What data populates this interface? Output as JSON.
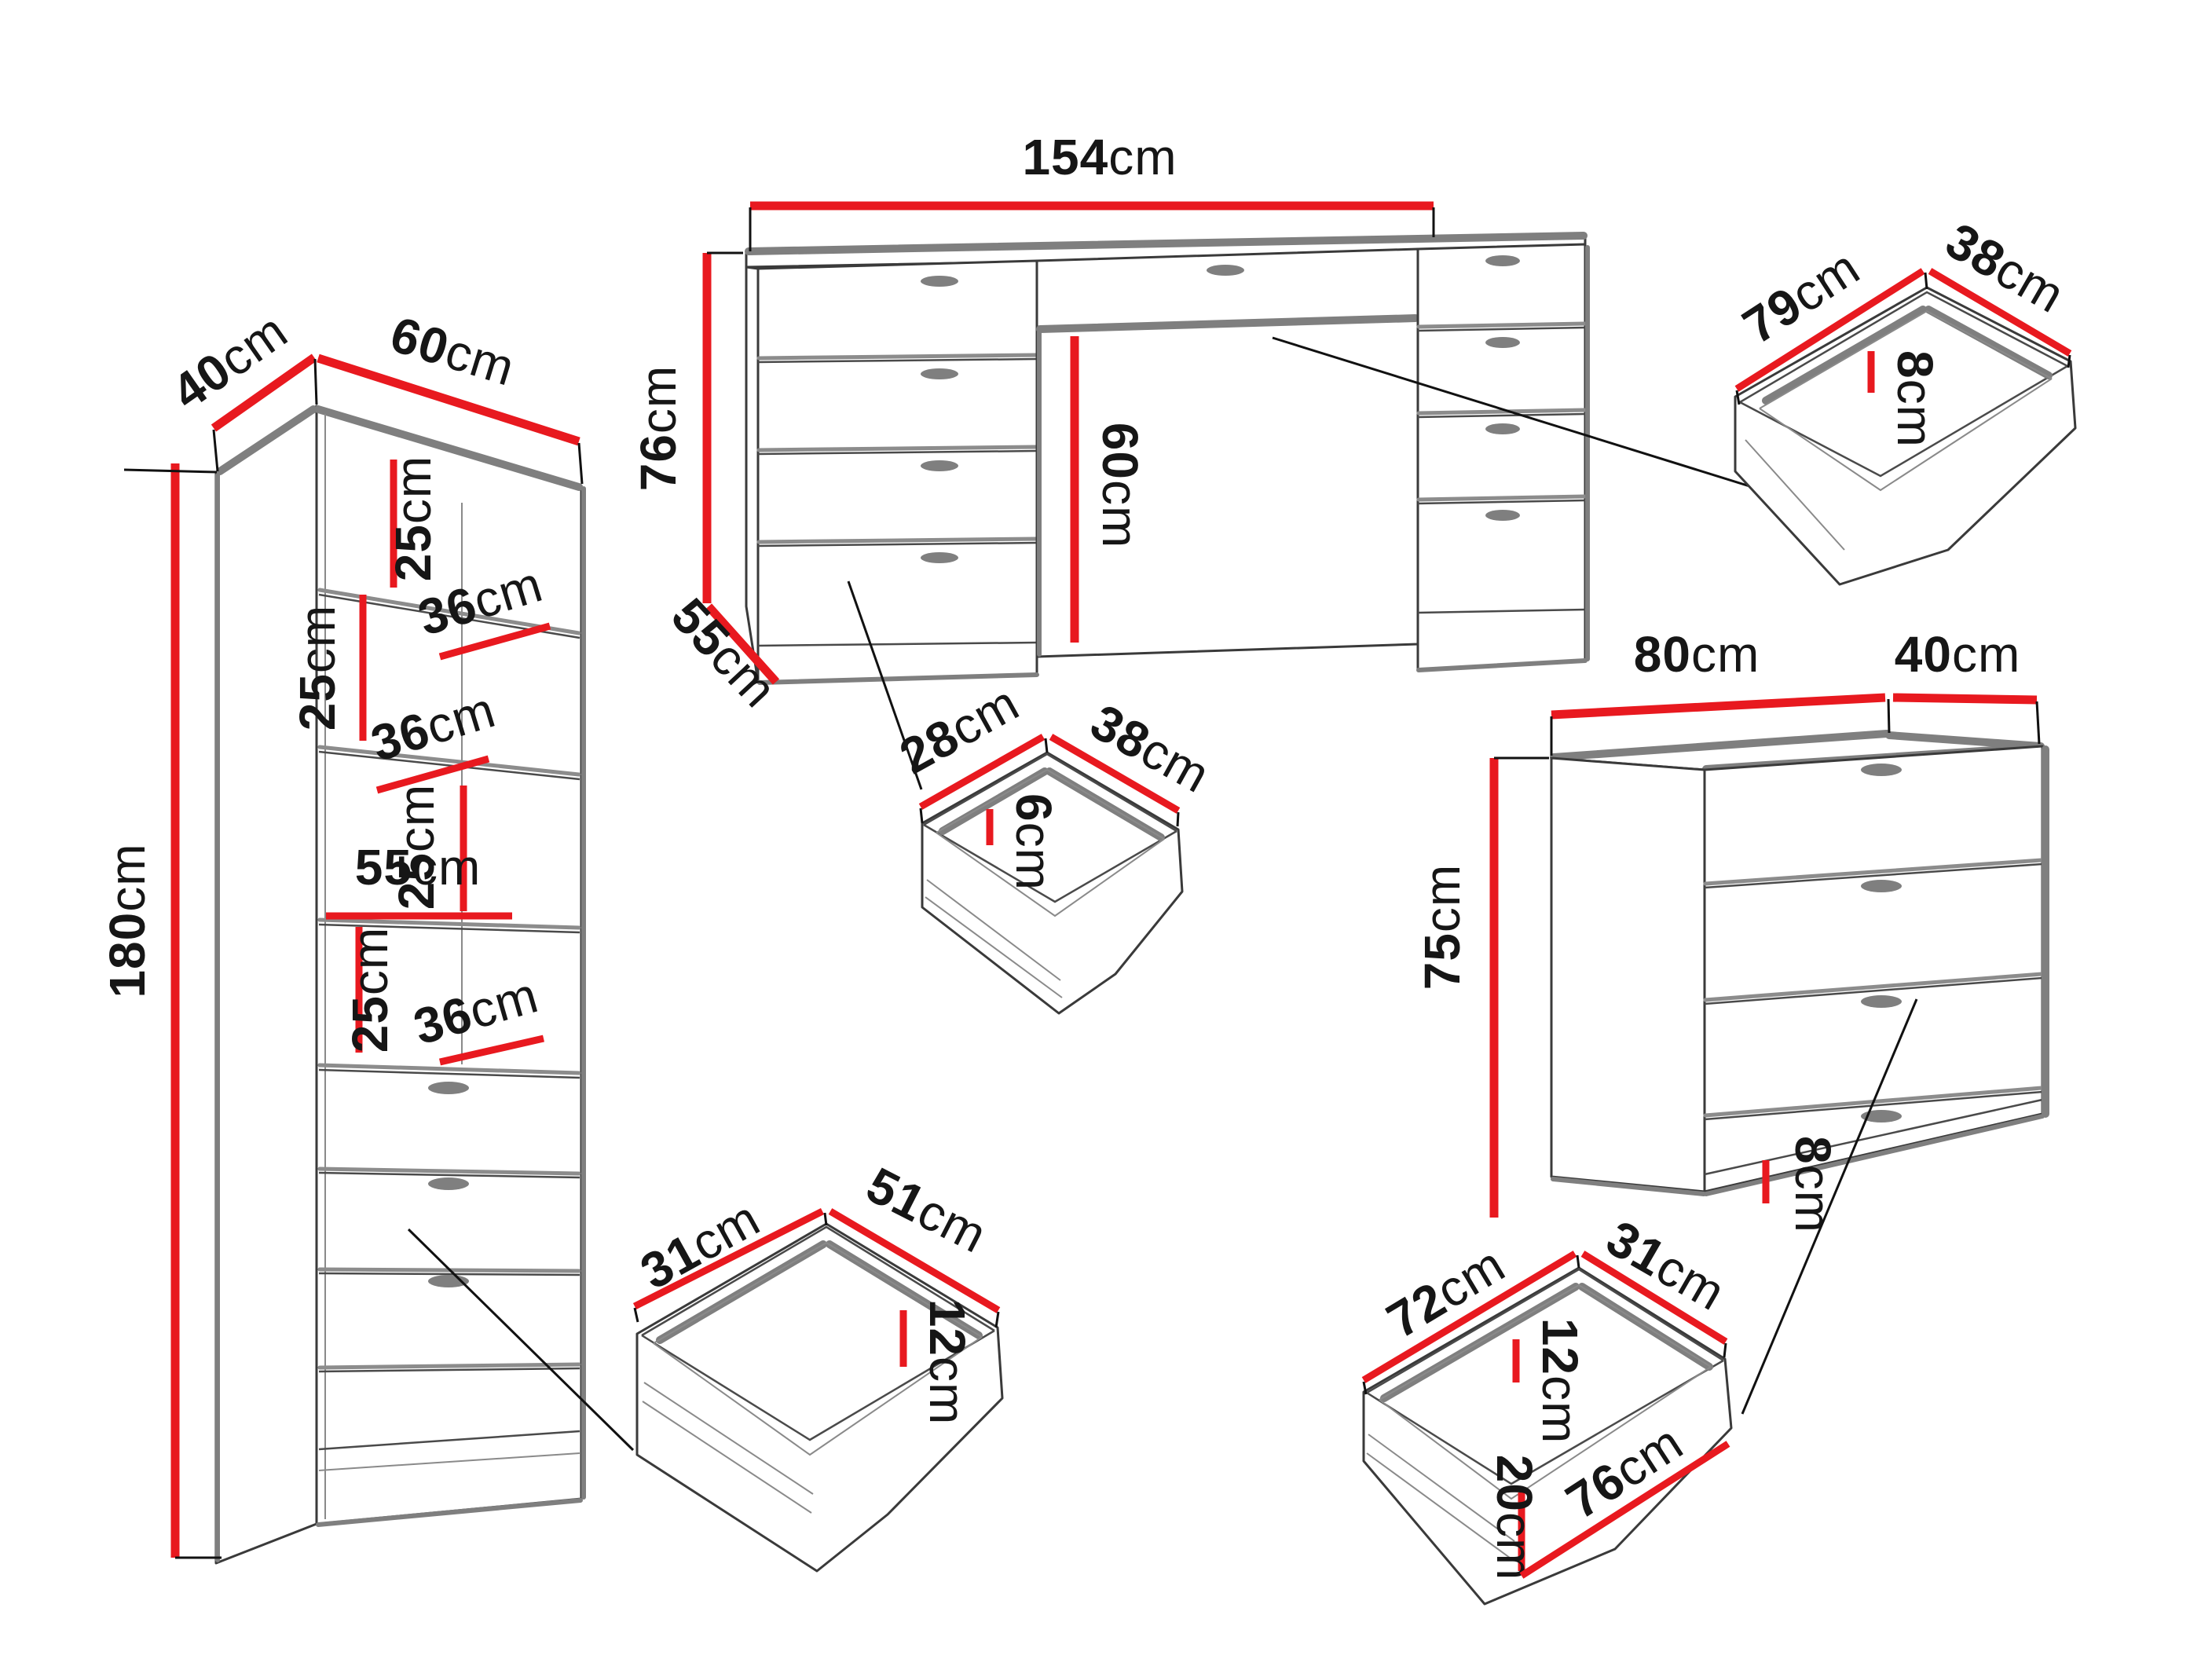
{
  "unit": "cm",
  "colors": {
    "dimension_red": "#e8191f",
    "outline_black": "#3a3a3a",
    "shadow_gray": "#7f7f7f"
  },
  "bookcase": {
    "height": "180",
    "top_depth": "40",
    "top_width": "60",
    "gap1": "25",
    "shelf1_depth": "36",
    "gap2": "25",
    "shelf2_depth": "36",
    "gap3": "25",
    "inner_width": "55",
    "gap4": "25",
    "shelf4_depth": "36"
  },
  "desk": {
    "width": "154",
    "height": "76",
    "depth": "55",
    "knee_height": "60",
    "drawer": {
      "depth": "28",
      "width": "38",
      "inner_height": "6"
    }
  },
  "side_drawer": {
    "depth": "79",
    "width": "38",
    "inner_height": "8"
  },
  "chest": {
    "width": "80",
    "depth": "40",
    "height": "75",
    "base_height": "8",
    "drawer": {
      "depth": "72",
      "width": "31",
      "inner_height": "12",
      "front_height": "20",
      "front_width": "76"
    }
  },
  "cabinet_drawer": {
    "depth": "31",
    "width": "51",
    "inner_height": "12"
  }
}
